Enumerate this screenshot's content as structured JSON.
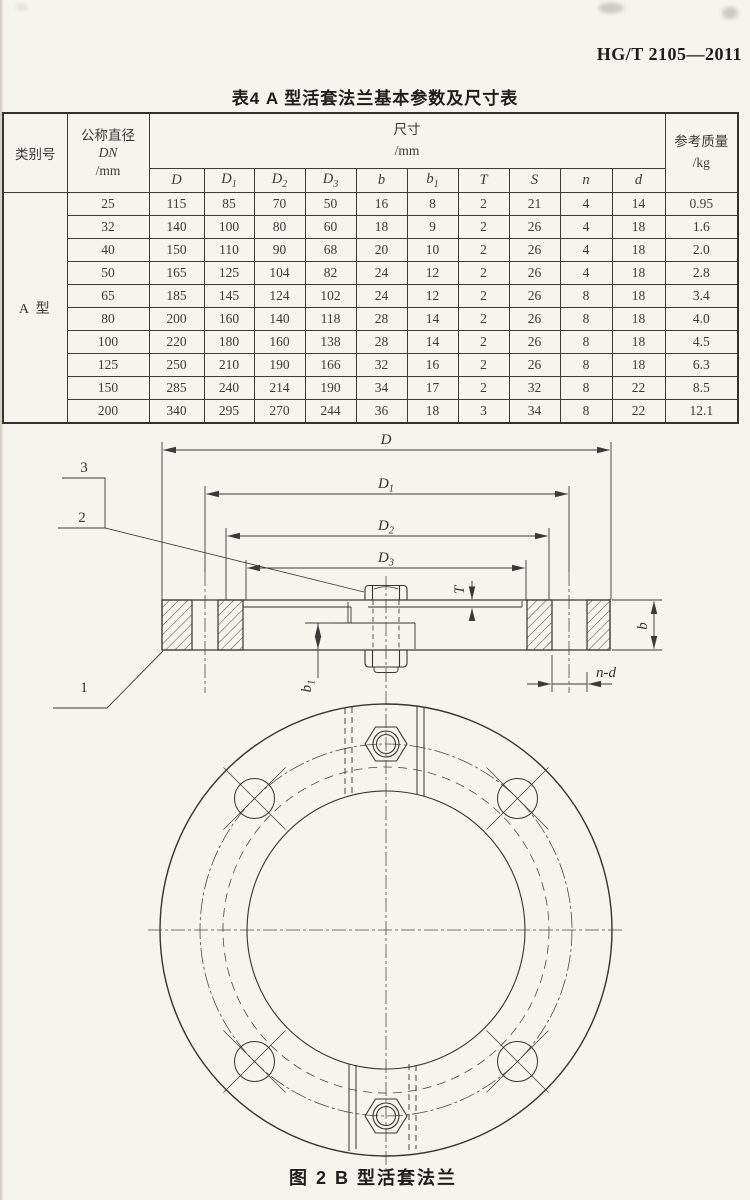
{
  "page": {
    "standard_code": "HG/T 2105—2011",
    "table_title": "表4  A 型活套法兰基本参数及尺寸表",
    "figure_caption": "图 2  B 型活套法兰"
  },
  "table": {
    "headers": {
      "category": "类别号",
      "dn": [
        "公称直径",
        "DN",
        "/mm"
      ],
      "size": [
        "尺寸",
        "/mm"
      ],
      "mass": [
        "参考质量",
        "/kg"
      ],
      "dim_columns": [
        {
          "base": "D",
          "sub": ""
        },
        {
          "base": "D",
          "sub": "1"
        },
        {
          "base": "D",
          "sub": "2"
        },
        {
          "base": "D",
          "sub": "3"
        },
        {
          "base": "b",
          "sub": ""
        },
        {
          "base": "b",
          "sub": "1"
        },
        {
          "base": "T",
          "sub": ""
        },
        {
          "base": "S",
          "sub": ""
        },
        {
          "base": "n",
          "sub": ""
        },
        {
          "base": "d",
          "sub": ""
        }
      ]
    },
    "category_value": "A 型",
    "rows": [
      {
        "dn": "25",
        "values": [
          "115",
          "85",
          "70",
          "50",
          "16",
          "8",
          "2",
          "21",
          "4",
          "14"
        ],
        "mass": "0.95"
      },
      {
        "dn": "32",
        "values": [
          "140",
          "100",
          "80",
          "60",
          "18",
          "9",
          "2",
          "26",
          "4",
          "18"
        ],
        "mass": "1.6"
      },
      {
        "dn": "40",
        "values": [
          "150",
          "110",
          "90",
          "68",
          "20",
          "10",
          "2",
          "26",
          "4",
          "18"
        ],
        "mass": "2.0"
      },
      {
        "dn": "50",
        "values": [
          "165",
          "125",
          "104",
          "82",
          "24",
          "12",
          "2",
          "26",
          "4",
          "18"
        ],
        "mass": "2.8"
      },
      {
        "dn": "65",
        "values": [
          "185",
          "145",
          "124",
          "102",
          "24",
          "12",
          "2",
          "26",
          "8",
          "18"
        ],
        "mass": "3.4"
      },
      {
        "dn": "80",
        "values": [
          "200",
          "160",
          "140",
          "118",
          "28",
          "14",
          "2",
          "26",
          "8",
          "18"
        ],
        "mass": "4.0"
      },
      {
        "dn": "100",
        "values": [
          "220",
          "180",
          "160",
          "138",
          "28",
          "14",
          "2",
          "26",
          "8",
          "18"
        ],
        "mass": "4.5"
      },
      {
        "dn": "125",
        "values": [
          "250",
          "210",
          "190",
          "166",
          "32",
          "16",
          "2",
          "26",
          "8",
          "18"
        ],
        "mass": "6.3"
      },
      {
        "dn": "150",
        "values": [
          "285",
          "240",
          "214",
          "190",
          "34",
          "17",
          "2",
          "32",
          "8",
          "22"
        ],
        "mass": "8.5"
      },
      {
        "dn": "200",
        "values": [
          "340",
          "295",
          "270",
          "244",
          "36",
          "18",
          "3",
          "34",
          "8",
          "22"
        ],
        "mass": "12.1"
      }
    ]
  },
  "drawing": {
    "dimensions": {
      "D": "D",
      "D1_base": "D",
      "D1_sub": "1",
      "D2_base": "D",
      "D2_sub": "2",
      "D3_base": "D",
      "D3_sub": "3",
      "T": "T",
      "b": "b",
      "b1_base": "b",
      "b1_sub": "1",
      "n_d": "n-d"
    },
    "callouts": {
      "c1": "1",
      "c2": "2",
      "c3": "3"
    }
  }
}
